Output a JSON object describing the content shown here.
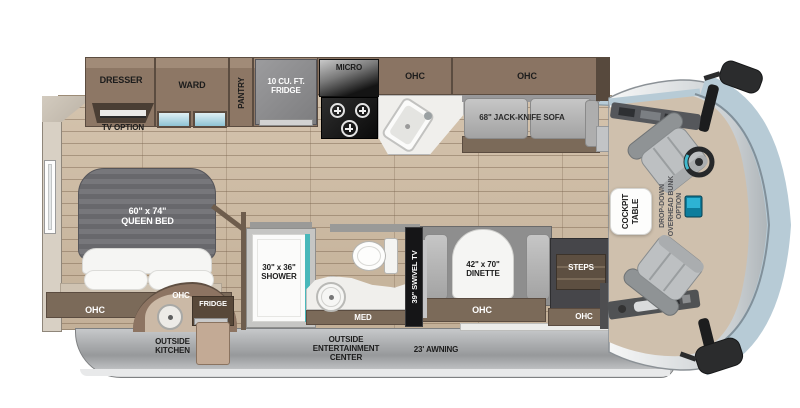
{
  "fp": {
    "top": {
      "dresser": "DRESSER",
      "ward": "WARD",
      "pantry": "PANTRY",
      "fridge10": "10 CU. FT.\nFRIDGE",
      "micro": "MICRO",
      "ohc_kitchen": "OHC",
      "ohc_sofa": "OHC",
      "tv_option": "TV OPTION",
      "sofa": "68\" JACK-KNIFE SOFA"
    },
    "bedroom": {
      "bed": "60\" x 74\"\nQUEEN BED",
      "ohc": "OHC"
    },
    "outside_kitchen": {
      "ohc": "OHC",
      "fridge": "FRIDGE",
      "label": "OUTSIDE\nKITCHEN"
    },
    "bath": {
      "shower": "30\" x 36\"\nSHOWER",
      "med": "MED",
      "tv": "39\" SWIVEL TV"
    },
    "dinette": {
      "table": "42\" x 70\"\nDINETTE",
      "ohc": "OHC"
    },
    "entry": {
      "steps": "STEPS",
      "ohc": "OHC"
    },
    "cockpit": {
      "table": "COCKPIT\nTABLE",
      "bunk": "DROP-DOWN\nOVERHEAD BUNK\nOPTION"
    },
    "exterior": {
      "entertainment": "OUTSIDE\nENTERTAINMENT\nCENTER",
      "awning": "23' AWNING"
    },
    "colors": {
      "wood": "#cdbaa3",
      "cabinet_brown": "#8a7463",
      "trim_dark": "#5b4c40",
      "mattress_gray": "#707074",
      "shower_glass": "#49b8ba",
      "windshield_blue": "#b7cbd6",
      "body_gray": "#a9acae",
      "cockpit_floor": "#cfc0ad"
    }
  }
}
